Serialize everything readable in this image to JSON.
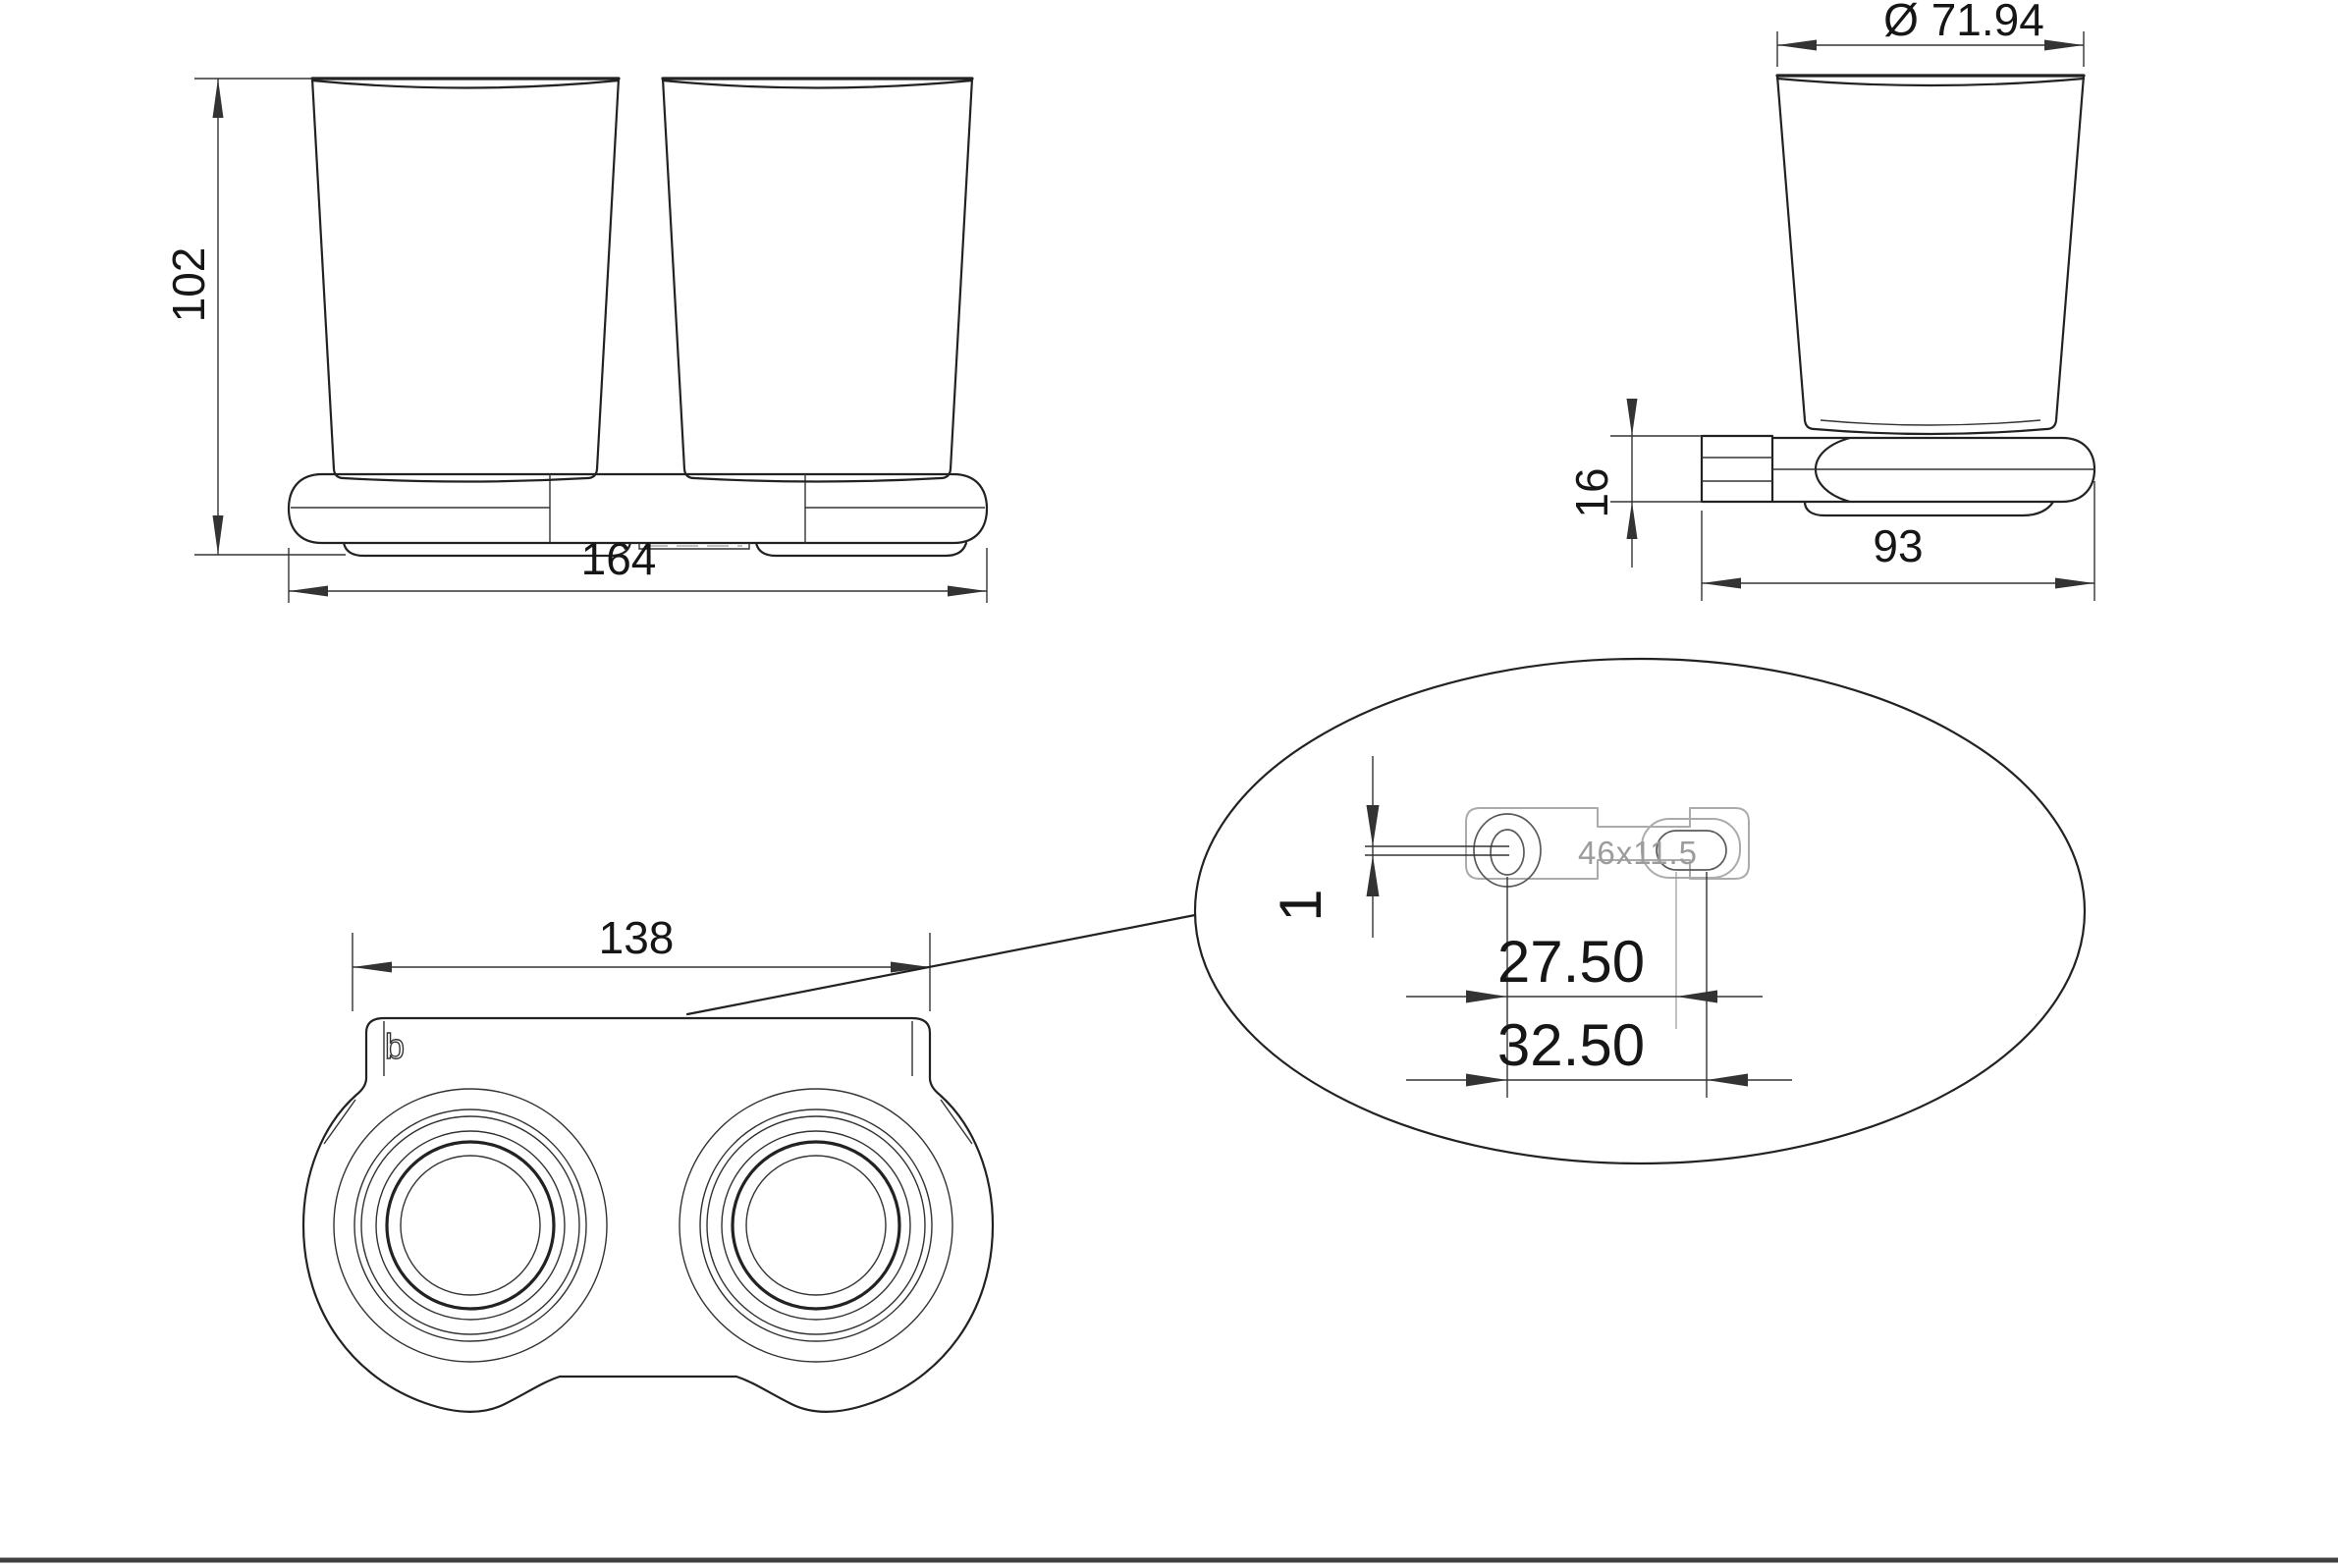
{
  "title": "double-tumbler-holder-technical-drawing",
  "colors": {
    "bg": "#ffffff",
    "line": "#222222",
    "thin": "#333333",
    "gray": "#ababab",
    "labelgray": "#9c9c9c",
    "border": "#3f3f3f"
  },
  "front_view": {
    "height_dim": "102",
    "width_dim": "164"
  },
  "side_view": {
    "diameter_dim": "Ø 71.94",
    "thickness_dim": "16",
    "depth_dim": "93"
  },
  "bottom_view": {
    "width_dim": "138",
    "logo": "b"
  },
  "detail_view": {
    "plate_size": "46x11.5",
    "offset_dim": "1",
    "hole_spacing": "27.50",
    "slot_spacing": "32.50"
  }
}
